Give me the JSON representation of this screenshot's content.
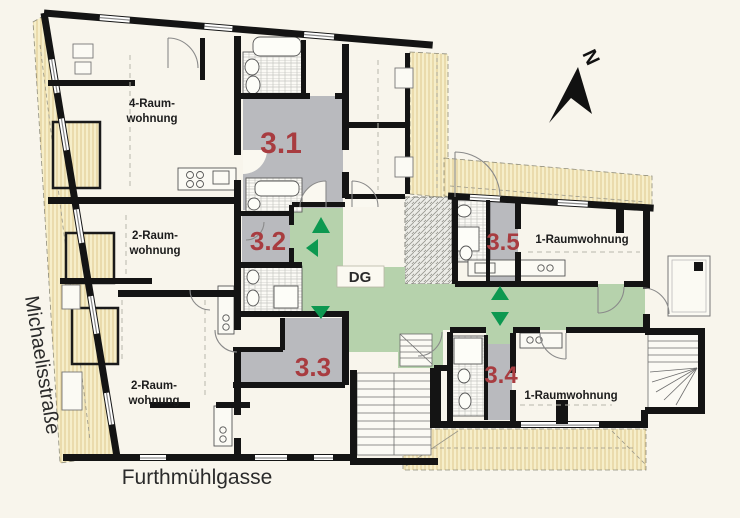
{
  "plan": {
    "north_label": "N",
    "level_badge": "DG",
    "streets": {
      "left": "Michaelisstraße",
      "bottom": "Furthmühlgasse"
    },
    "apartments": [
      {
        "id": "apartment-4-raum",
        "lines": [
          "4-Raum-",
          "wohnung"
        ]
      },
      {
        "id": "apartment-2-raum-middle",
        "lines": [
          "2-Raum-",
          "wohnung"
        ]
      },
      {
        "id": "apartment-2-raum-bottom",
        "lines": [
          "2-Raum-",
          "wohnung"
        ]
      },
      {
        "id": "apartment-1-raum-top",
        "lines": [
          "1-Raumwohnung"
        ]
      },
      {
        "id": "apartment-1-raum-bottom",
        "lines": [
          "1-Raumwohnung"
        ]
      }
    ],
    "units": [
      {
        "number": "3.1"
      },
      {
        "number": "3.2"
      },
      {
        "number": "3.3"
      },
      {
        "number": "3.4"
      },
      {
        "number": "3.5"
      }
    ],
    "colors": {
      "background": "#f8f5ec",
      "wall": "#141414",
      "unit_number": "#a83c40",
      "circulation_green": "#b6d2ac",
      "arrow_green": "#0d9850",
      "stair_zone_gray": "#b9babe",
      "roof_beige": "#f6eec9",
      "label_text": "#1c1c1c"
    }
  }
}
